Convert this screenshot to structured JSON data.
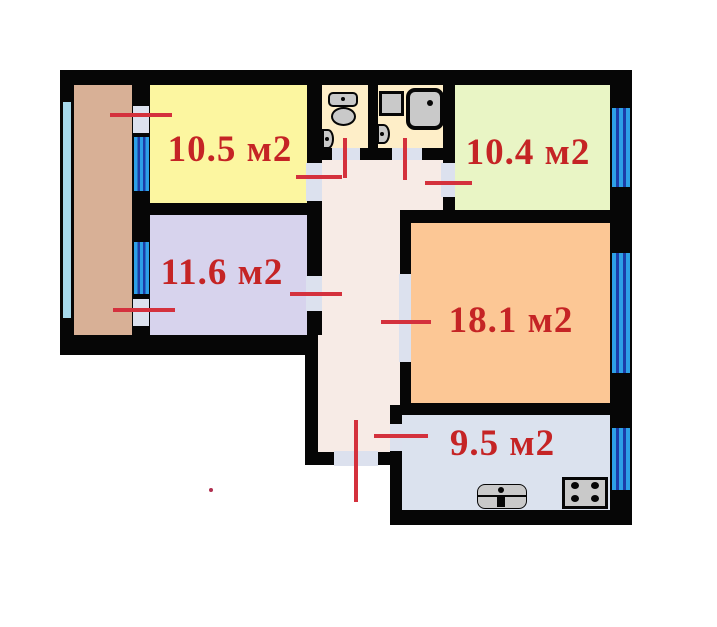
{
  "colors": {
    "bg": "#ffffff",
    "wall": "#060606",
    "balcony": "#d8b096",
    "room1": "#fcf6a0",
    "room2": "#e9f5c5",
    "room3": "#d7d3ed",
    "room4": "#fcc795",
    "kitchenRoom": "#dbe2ee",
    "hallway": "#f7ebe6",
    "sanitary": "#feeec8",
    "door": "#dce1ee",
    "windowLight": "#2da0e6",
    "windowDark": "#1c3da8",
    "glazing": "#a6d9ec",
    "redLine": "#d4313d",
    "labelRed": "#c52425",
    "fixture": "#c9c9c9"
  },
  "rooms": [
    {
      "id": "bedroom-top-left",
      "area_label": "10.5 м2"
    },
    {
      "id": "bedroom-top-right",
      "area_label": "10.4 м2"
    },
    {
      "id": "bedroom-mid-left",
      "area_label": "11.6 м2"
    },
    {
      "id": "living-room",
      "area_label": "18.1 м2"
    },
    {
      "id": "kitchen",
      "area_label": "9.5 м2"
    }
  ],
  "unlabeled_spaces": [
    "balcony",
    "hallway",
    "toilet-room",
    "bathroom"
  ],
  "fixture_icons": [
    "toilet-icon",
    "wash-sink-icon",
    "shower-box-icon",
    "bathtub-icon",
    "wash-sink-icon",
    "kitchen-sink-icon",
    "stove-icon"
  ],
  "window_count": 5,
  "door_marks_color_note": "red lines mark doors and entrance"
}
